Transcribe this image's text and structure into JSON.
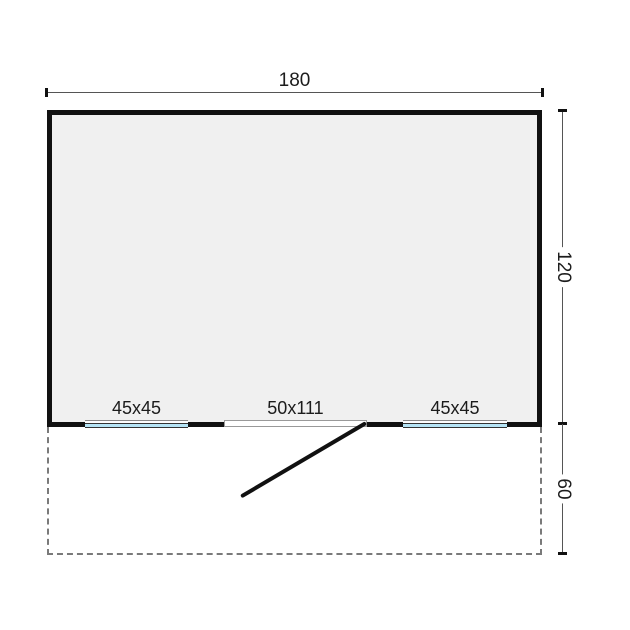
{
  "floorplan": {
    "dimensions": {
      "width_label": "180",
      "height_label": "120",
      "veranda_depth_label": "60"
    },
    "openings": {
      "left_window_label": "45x45",
      "door_label": "50x111",
      "right_window_label": "45x45"
    },
    "colors": {
      "wall": "#111111",
      "interior": "#f0f0f0",
      "window_glass": "#b5e4f5",
      "dimension_line": "#555555",
      "dashed_outline": "#7a7a7a",
      "text": "#1c1c1c",
      "page_bg": "#ffffff"
    }
  }
}
